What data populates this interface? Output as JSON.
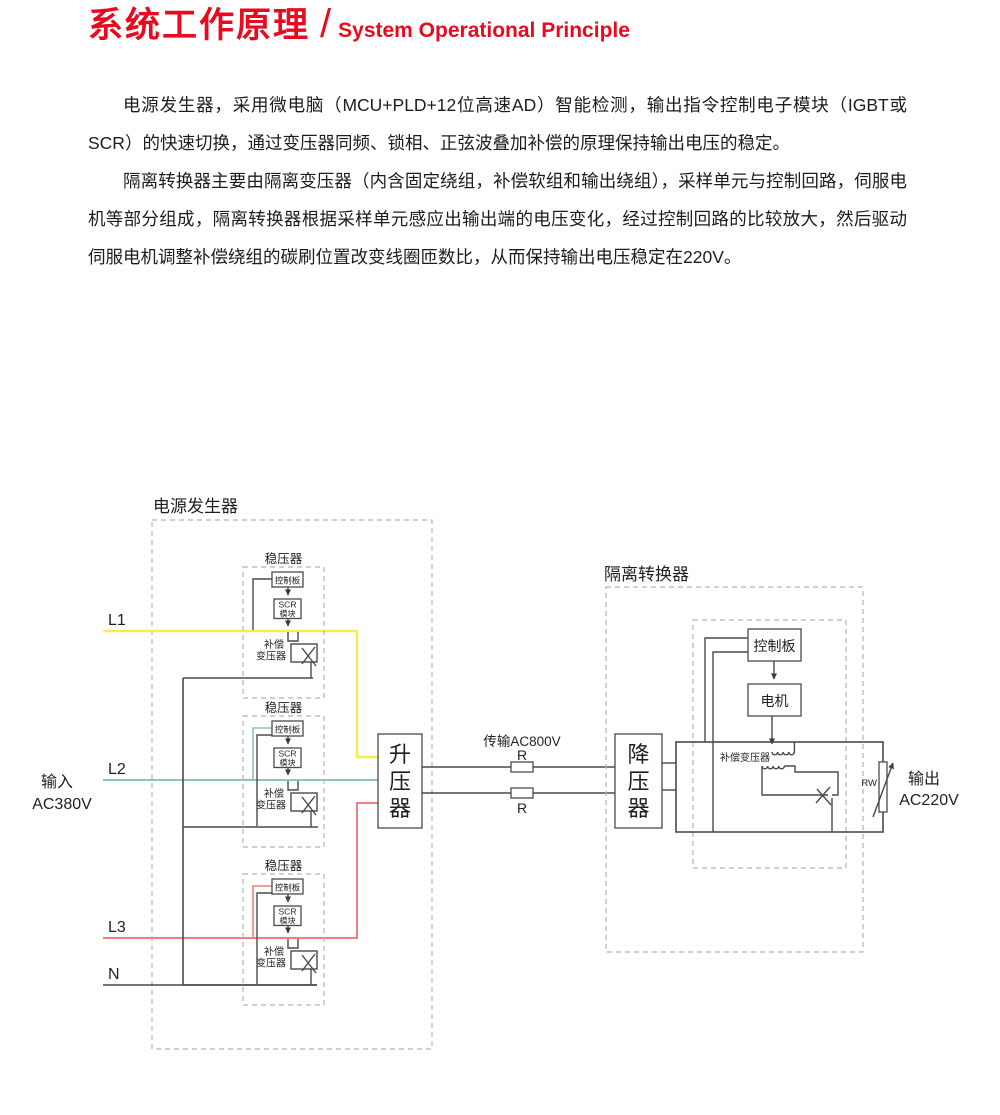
{
  "header": {
    "title_zh": "系统工作原理",
    "slash": "/",
    "title_en": "System Operational Principle",
    "accent_color": "#e60b1e"
  },
  "paragraphs": {
    "p1": "电源发生器，采用微电脑（MCU+PLD+12位高速AD）智能检测，输出指令控制电子模块（IGBT或SCR）的快速切换，通过变压器同频、锁相、正弦波叠加补偿的原理保持输出电压的稳定。",
    "p2": "隔离转换器主要由隔离变压器（内含固定绕组，补偿软组和输出绕组），采样单元与控制回路，伺服电机等部分组成，隔离转换器根据采样单元感应出输出端的电压变化，经过控制回路的比较放大，然后驱动伺服电机调整补偿绕组的碳刷位置改变线圈匝数比，从而保持输出电压稳定在220V。"
  },
  "diagram": {
    "generator_title": "电源发生器",
    "isolator_title": "隔离转换器",
    "input": {
      "line1": "输入",
      "line2": "AC380V",
      "phase_labels": {
        "l1": "L1",
        "l2": "L2",
        "l3": "L3",
        "n": "N"
      }
    },
    "phase_colors": {
      "l1": "#ffe94d",
      "l2": "#8cc7ae",
      "l3": "#f27f7f",
      "neutral": "#4a4a4a"
    },
    "regulator": {
      "title": "稳压器",
      "control_board": "控制板",
      "scr_line1": "SCR",
      "scr_line2": "模块",
      "comp_line1": "补偿",
      "comp_line2": "变压器"
    },
    "booster": {
      "char1": "升",
      "char2": "压",
      "char3": "器"
    },
    "stepdown": {
      "char1": "降",
      "char2": "压",
      "char3": "器"
    },
    "transmission": {
      "label": "传输AC800V",
      "r_label": "R"
    },
    "isolator": {
      "control_board": "控制板",
      "motor": "电机",
      "comp_transformer": "补偿变压器",
      "rw_label": "RW"
    },
    "output": {
      "line1": "输出",
      "line2": "AC220V"
    }
  }
}
